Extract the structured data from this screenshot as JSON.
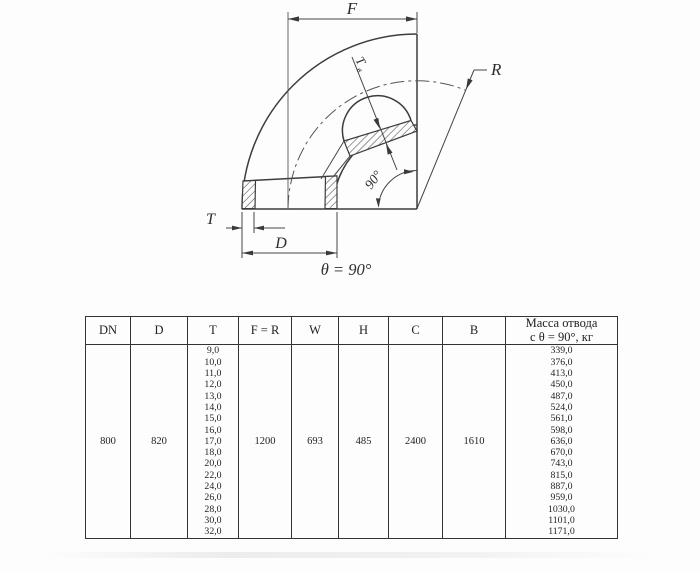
{
  "drawing": {
    "label_f": "F",
    "label_r": "R",
    "label_tb_main": "Т",
    "label_tb_sub": "в",
    "label_angle": "90°",
    "label_t": "T",
    "label_d": "D",
    "label_theta": "θ = 90°"
  },
  "table": {
    "headers": [
      "DN",
      "D",
      "T",
      "F = R",
      "W",
      "H",
      "C",
      "B"
    ],
    "mass_header_line1": "Масса отвода",
    "mass_header_line2": "с θ =  90°, кг",
    "dn": "800",
    "d": "820",
    "f_r": "1200",
    "w": "693",
    "h": "485",
    "c": "2400",
    "b": "1610",
    "t_values": [
      "9,0",
      "10,0",
      "11,0",
      "12,0",
      "13,0",
      "14,0",
      "15,0",
      "16,0",
      "17,0",
      "18,0",
      "20,0",
      "22,0",
      "24,0",
      "26,0",
      "28,0",
      "30,0",
      "32,0"
    ],
    "mass_values": [
      "339,0",
      "376,0",
      "413,0",
      "450,0",
      "487,0",
      "524,0",
      "561,0",
      "598,0",
      "636,0",
      "670,0",
      "743,0",
      "815,0",
      "887,0",
      "959,0",
      "1030,0",
      "1101,0",
      "1171,0"
    ]
  }
}
